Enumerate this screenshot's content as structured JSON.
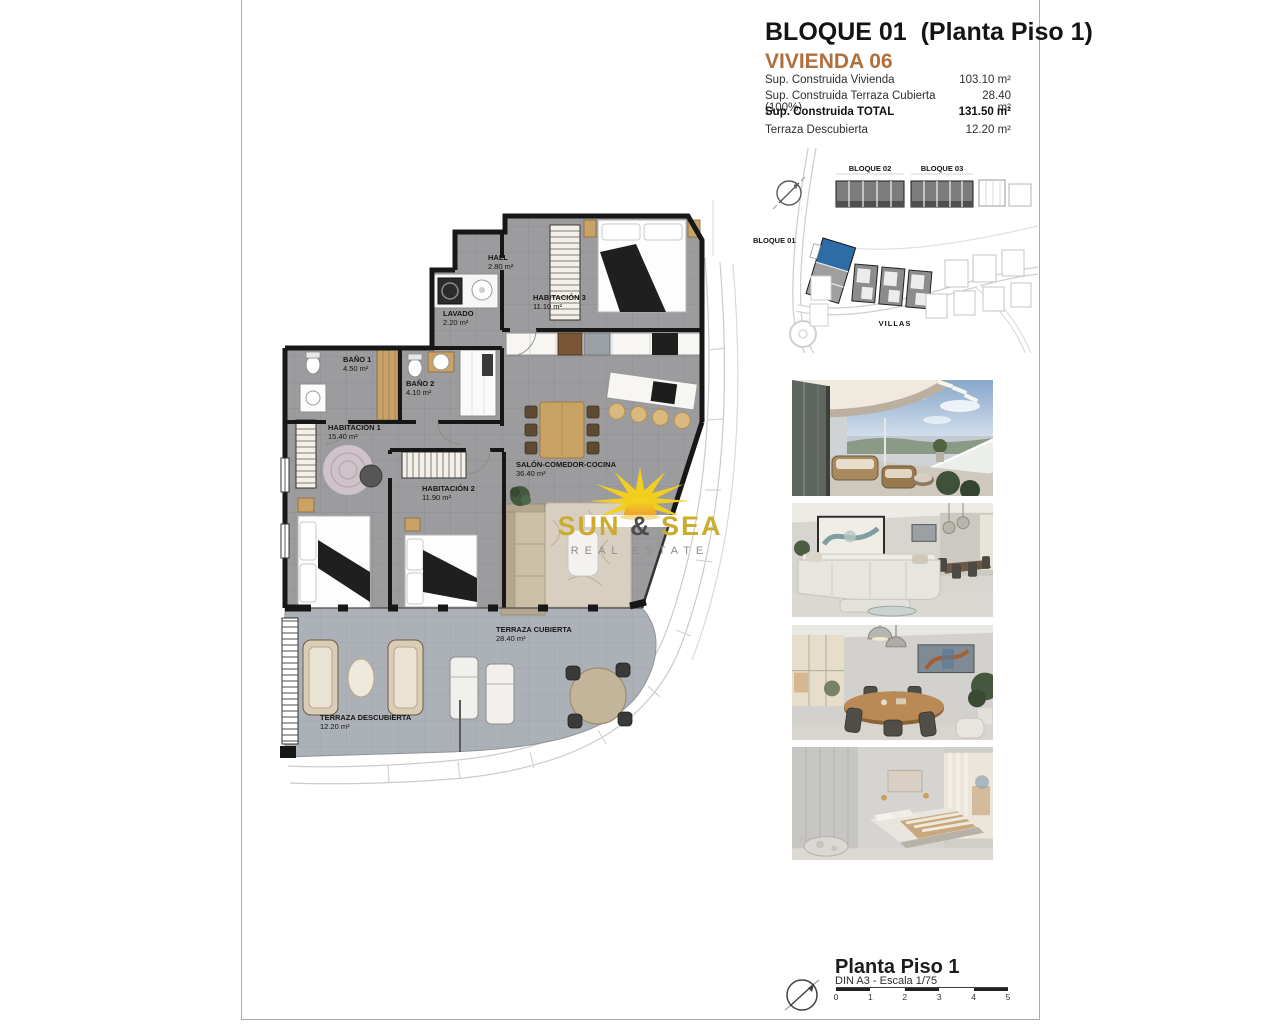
{
  "header": {
    "title": "BLOQUE 01  (Planta Piso 1)",
    "subtitle": "VIVIENDA 06",
    "accent_color": "#b06f3c"
  },
  "surface_table": {
    "rows": [
      {
        "label": "Sup. Construida Vivienda",
        "value": "103.10 m²"
      },
      {
        "label": "Sup. Construida Terraza Cubierta (100%)",
        "value": "28.40 m²"
      },
      {
        "label": "Sup. Construida TOTAL",
        "value": "131.50 m²"
      },
      {
        "label": "Terraza Descubierta",
        "value": "12.20 m²"
      }
    ]
  },
  "site_plan": {
    "bloque01": "BLOQUE 01",
    "bloque02": "BLOQUE 02",
    "bloque03": "BLOQUE 03",
    "villas": "VILLAS",
    "highlight_color": "#2e6ca8"
  },
  "floor_plan": {
    "rooms": [
      {
        "name": "HALL",
        "area": "2.80 m²"
      },
      {
        "name": "LAVADO",
        "area": "2.20 m²"
      },
      {
        "name": "HABITACIÓN 3",
        "area": "11.10 m²"
      },
      {
        "name": "BAÑO 1",
        "area": "4.50 m²"
      },
      {
        "name": "BAÑO 2",
        "area": "4.10 m²"
      },
      {
        "name": "HABITACIÓN 1",
        "area": "15.40 m²"
      },
      {
        "name": "HABITACIÓN 2",
        "area": "11.90 m²"
      },
      {
        "name": "SALÓN-COMEDOR-COCINA",
        "area": "36.40 m²"
      },
      {
        "name": "TERRAZA CUBIERTA",
        "area": "28.40 m²"
      },
      {
        "name": "TERRAZA DESCUBIERTA",
        "area": "12.20 m²"
      }
    ]
  },
  "watermark": {
    "word1": "SUN",
    "amp": "&",
    "word2": "SEA",
    "tagline": "REAL ESTATE",
    "gold": "#ccac2f"
  },
  "photos": [
    {
      "name": "terrace"
    },
    {
      "name": "living-room"
    },
    {
      "name": "dining-room"
    },
    {
      "name": "bedroom"
    }
  ],
  "footer": {
    "title": "Planta Piso 1",
    "scale_note": "DIN A3 - Escala 1/75",
    "scale_ticks": [
      "0",
      "1",
      "2",
      "3",
      "4",
      "5"
    ]
  }
}
